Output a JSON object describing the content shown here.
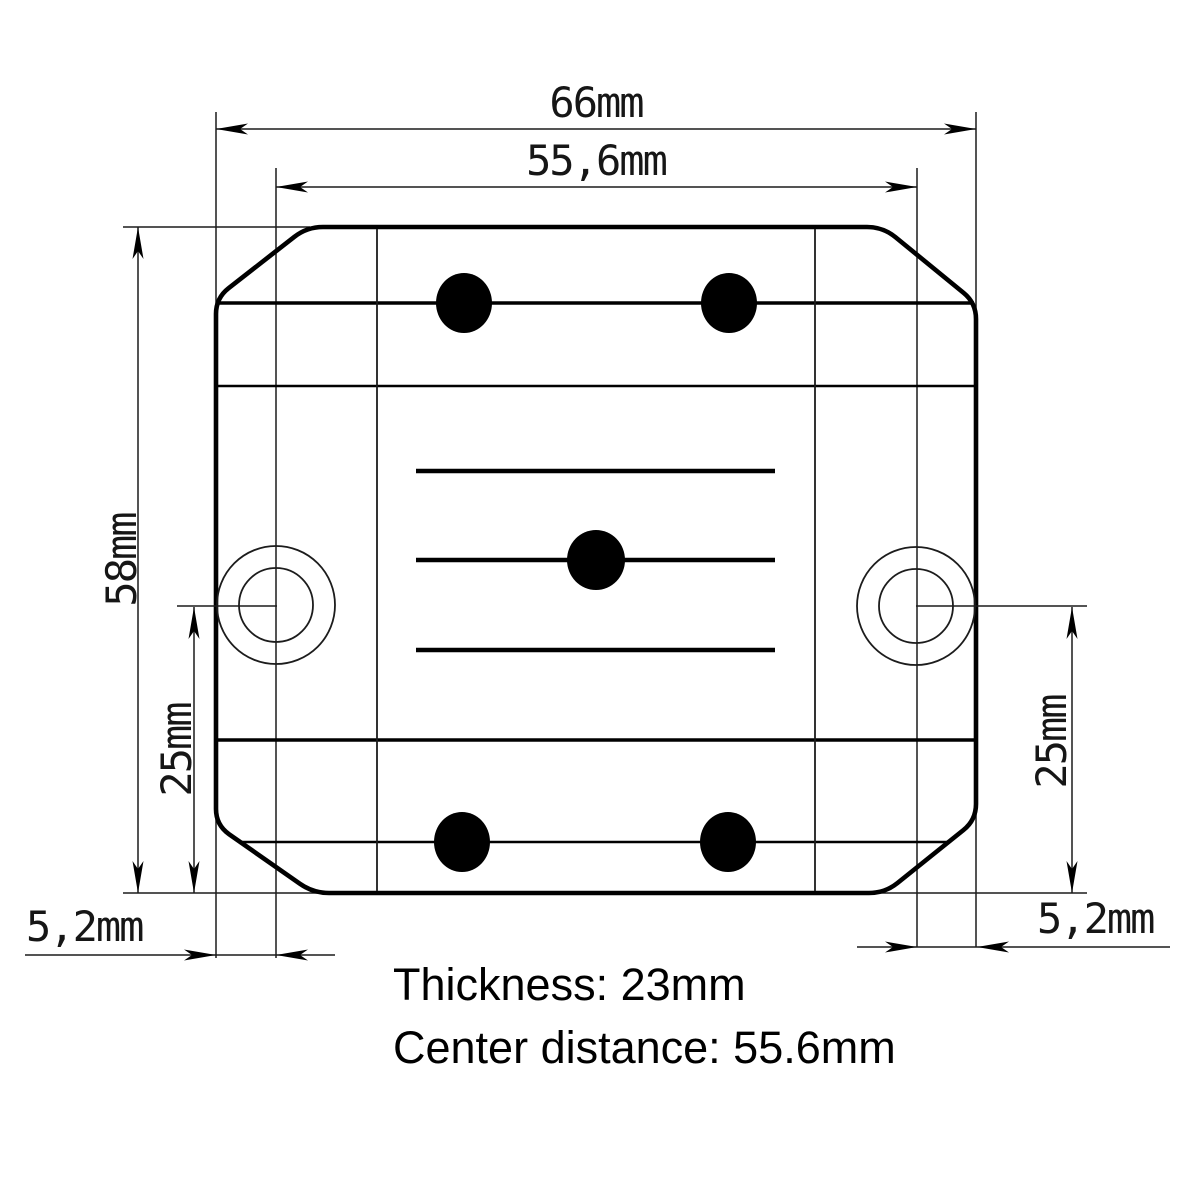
{
  "drawing": {
    "labels": {
      "overall_width": "66mm",
      "hole_spacing": "55,6mm",
      "overall_height": "58mm",
      "hole_offset_left": "25mm",
      "hole_offset_right": "25mm",
      "edge_to_hole_left": "5,2mm",
      "edge_to_hole_right": "5,2mm"
    },
    "notes": {
      "thickness": "Thickness: 23mm",
      "center_distance": "Center distance: 55.6mm"
    },
    "colors": {
      "ink": "#000000",
      "paper": "#ffffff"
    }
  }
}
